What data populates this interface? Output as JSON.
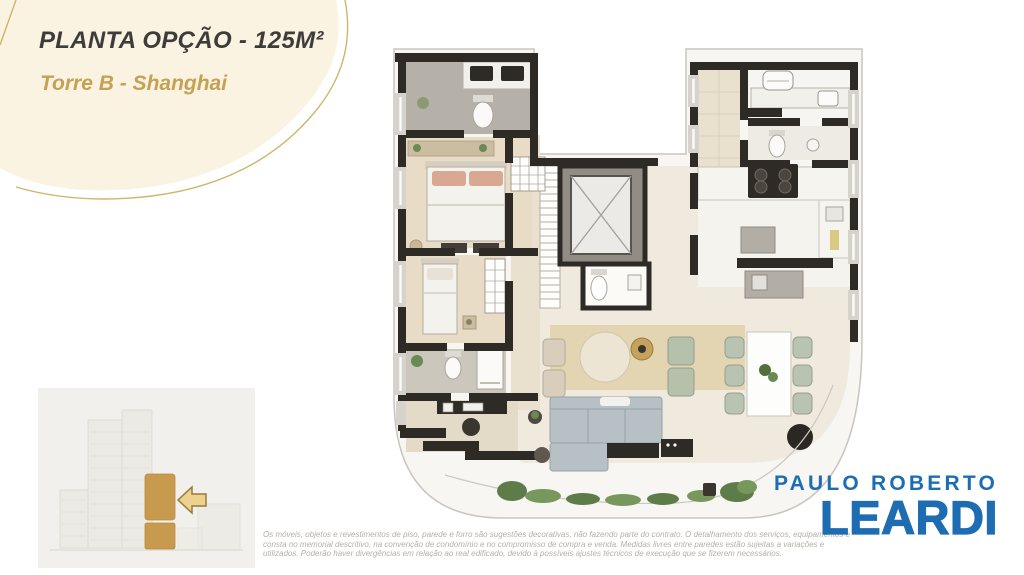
{
  "plan_header": {
    "title": "PLANTA OPÇÃO - 125M²",
    "subtitle": "Torre B - Shanghai"
  },
  "logo": {
    "line1": "PAULO ROBERTO",
    "line2": "LEARDI"
  },
  "disclaimer": {
    "line1": "Os móveis, objetos e revestimentos de piso, parede e forro são sugestões decorativas, não fazendo parte do contrato. O detalhamento dos serviços, equipamentos e",
    "line2": "consta no memorial descritivo, na convenção de condomínio e no compromisso de compra e venda. Medidas livres entre paredes estão sujeitas a variações e",
    "line3": "utilizados. Poderão haver divergências em relação ao real edificado, devido à possíveis ajustes técnicos de execução que se fizerem necessários."
  },
  "colors": {
    "brand_blue": "#1e6db2",
    "accent_gold": "#c5a155",
    "blob_cream": "#faf3e1",
    "highlight_gold": "#c79a4e",
    "wall_dark": "#2e2b27"
  }
}
